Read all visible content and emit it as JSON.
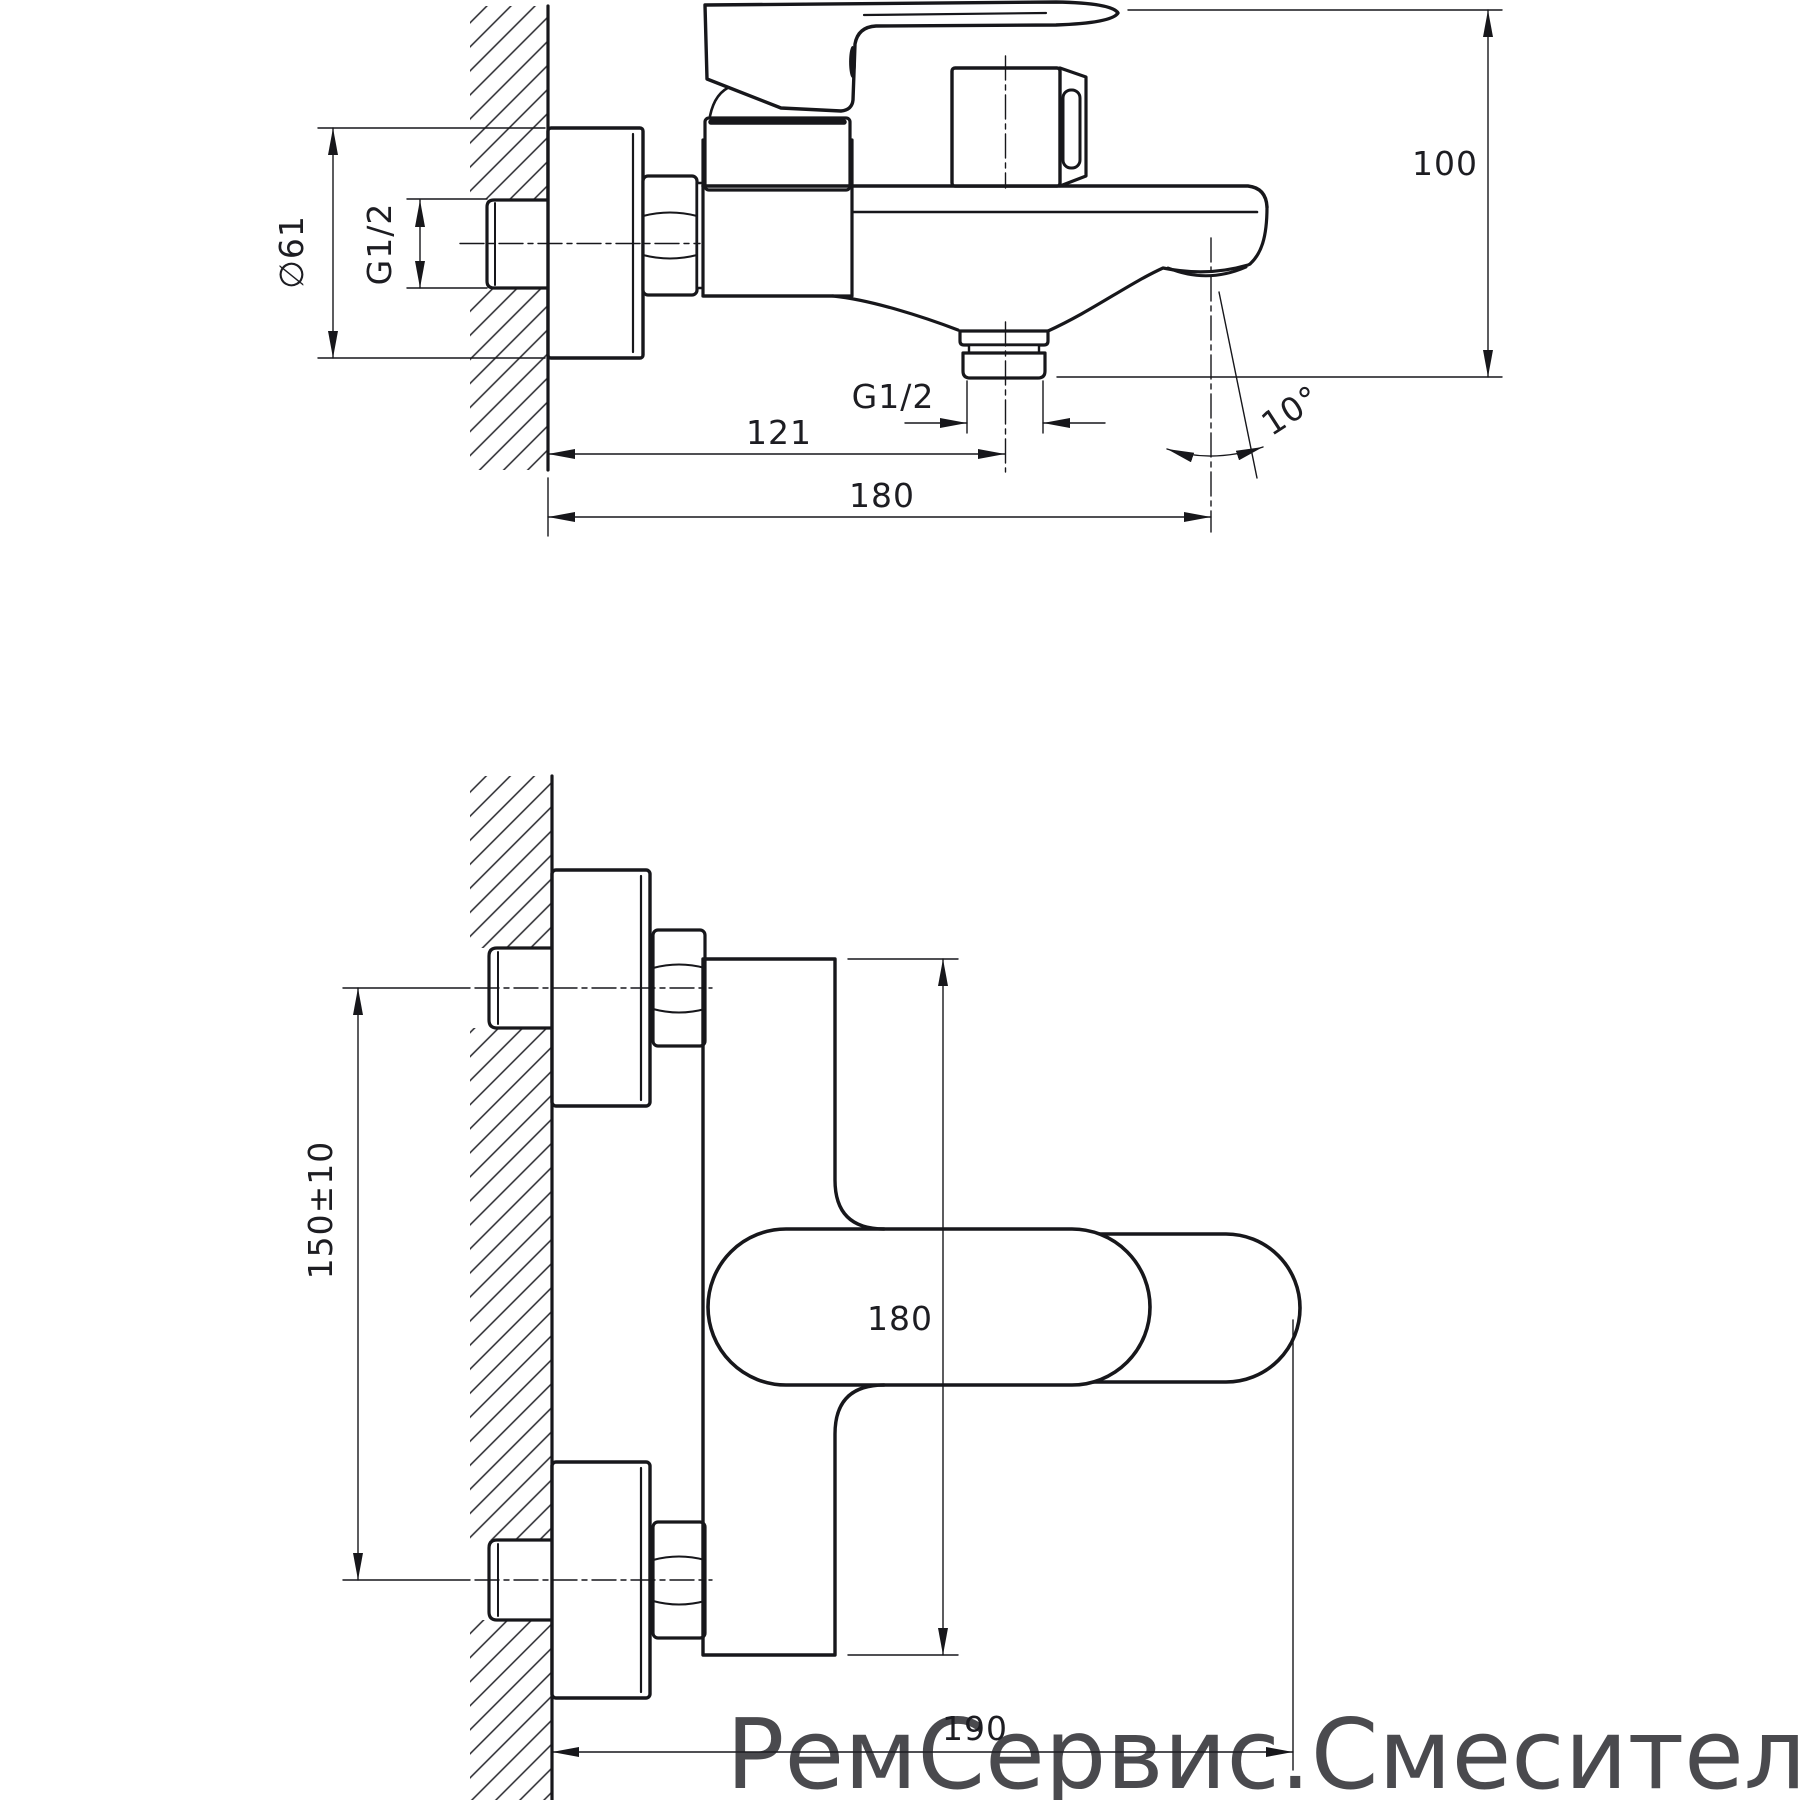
{
  "drawing": {
    "type": "technical-drawing",
    "subject": "wall-mounted bath mixer faucet, two orthographic views with dimensions",
    "line_color": "#17171b",
    "views": {
      "side": {
        "dims": {
          "escutcheon_diameter": "∅61",
          "wall_connection_thread": "G1/2",
          "shower_outlet_thread": "G1/2",
          "wall_to_shower_outlet": "121",
          "wall_to_spout_end": "180",
          "overall_height": "100",
          "spout_angle": "10°"
        }
      },
      "front": {
        "dims": {
          "connection_centers": "150±10",
          "body_height": "180",
          "wall_to_handle_end": "190"
        }
      }
    },
    "watermark": {
      "text": "РемСервис.Смесители",
      "color": "#a98f8b"
    }
  }
}
